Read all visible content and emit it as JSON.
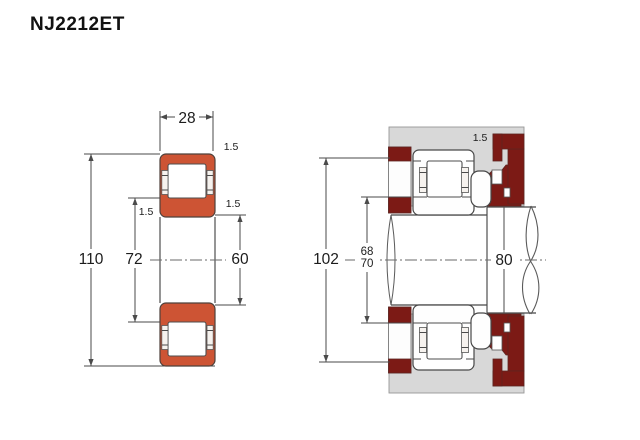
{
  "title": "NJ2212ET",
  "colors": {
    "bearing_orange": "#cd5434",
    "abutment_maroon": "#7c1a15",
    "housing_gray": "#d8d8d8",
    "outline": "#3f3f3f"
  },
  "left_view": {
    "label": "bearing cross-section view",
    "dims": {
      "width": "28",
      "outer_diameter": "110",
      "inner_race_diameter": "72",
      "flange_diameter": "60",
      "chamfer_outer": "1.5",
      "chamfer_inner": "1.5",
      "chamfer_flange": "1.5"
    }
  },
  "right_view": {
    "label": "mounted bearing with shaft and housing abutments",
    "dims": {
      "housing_abutment_diameter": "102",
      "shaft_abutment_min": "68",
      "shaft_abutment_max": "70",
      "shaft_diameter": "80",
      "fillet_radius": "1.5"
    }
  }
}
